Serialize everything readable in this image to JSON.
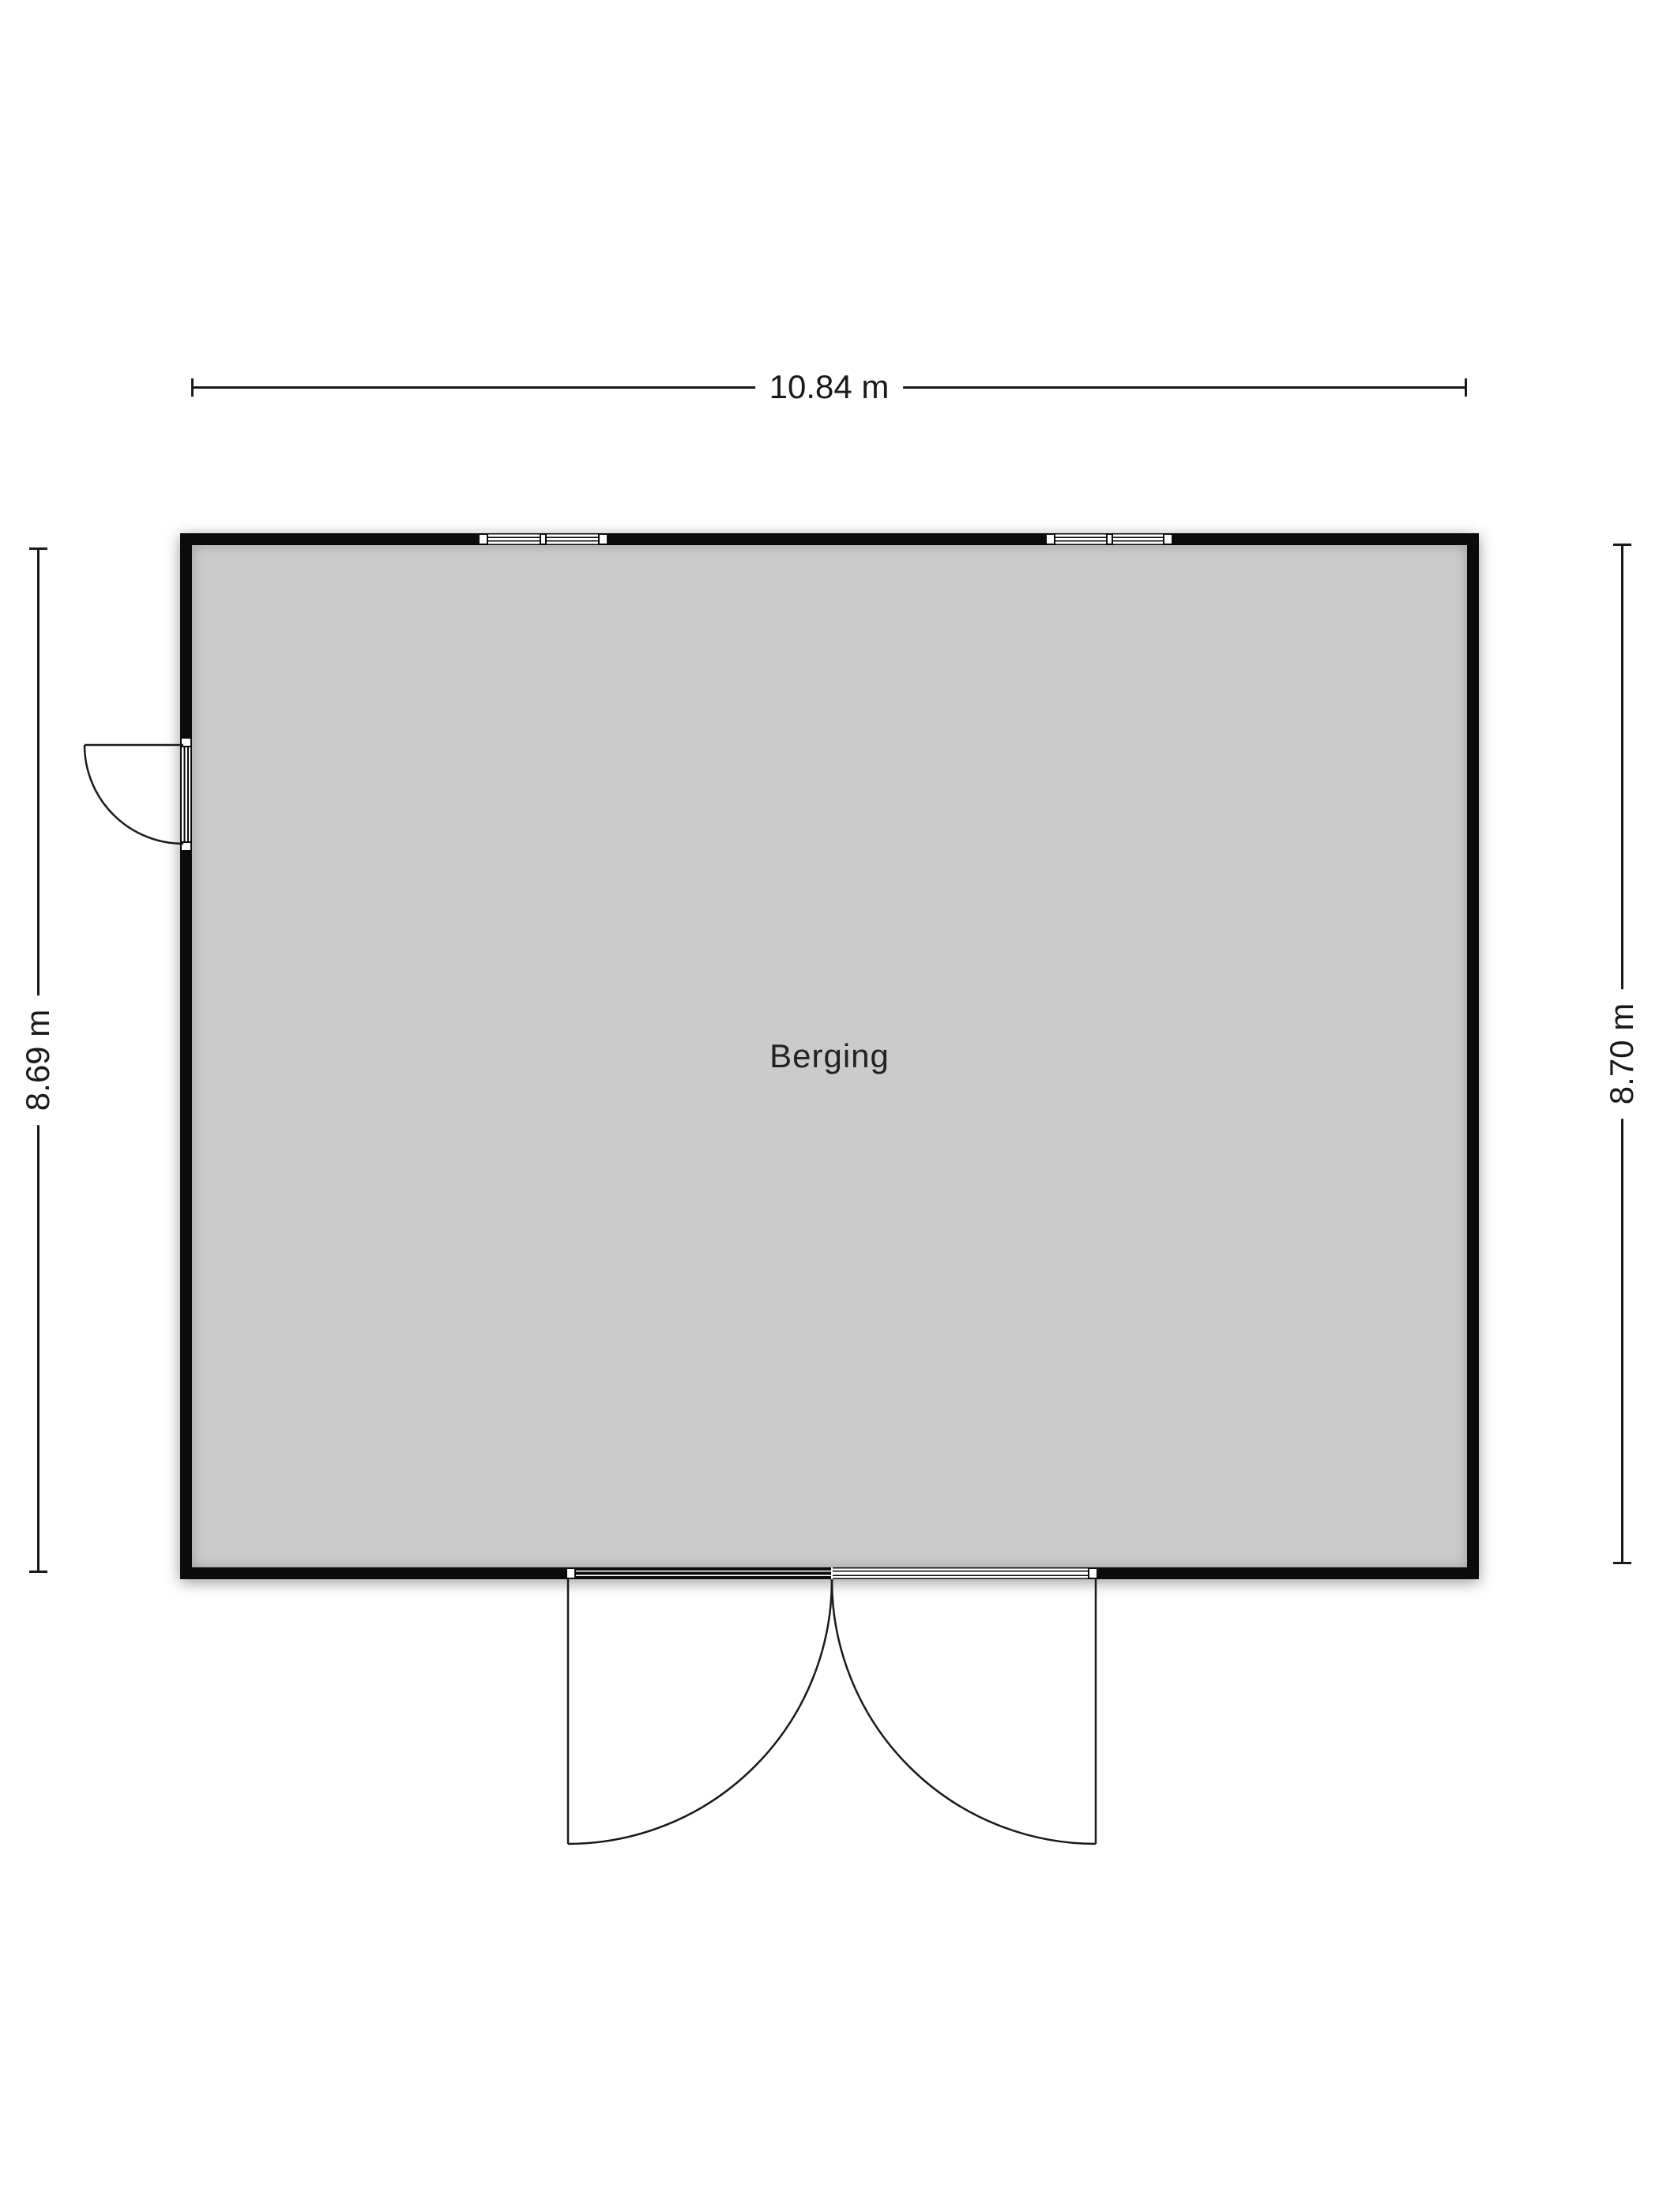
{
  "floorplan": {
    "room_label": "Berging",
    "dim_width": "10.84 m",
    "dim_height_left": "8.69 m",
    "dim_height_right": "8.70 m",
    "colors": {
      "wall": "#0b0b0b",
      "floor": "#cbcbcb",
      "line": "#1a1a1a",
      "background": "#ffffff"
    },
    "symbols": {
      "windows_top_wall": 2,
      "single_door_left_wall": 1,
      "double_door_bottom_wall": 1
    }
  }
}
